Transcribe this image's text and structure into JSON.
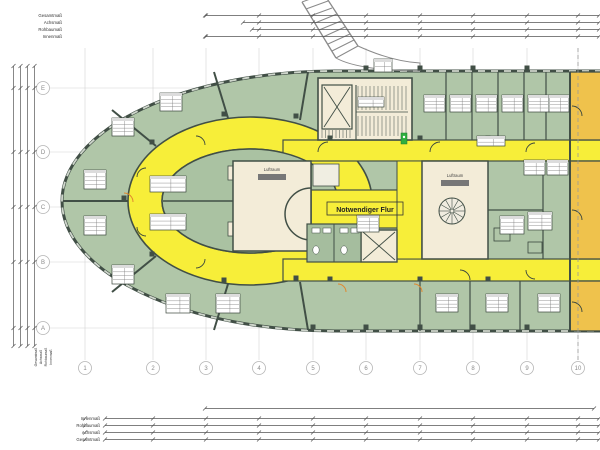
{
  "colors": {
    "room_green": "#b0c6a8",
    "island_green": "#aac2a2",
    "wc_green": "#a5bd9e",
    "corridor_yellow": "#f7ee39",
    "void_beige": "#f3ecd8",
    "orange_room": "#efc24c",
    "wall": "#414f46",
    "grid_gray": "#d4d4d4",
    "dim_line": "#555555",
    "exit_green": "#2fae3e",
    "door_orange": "#e0882f"
  },
  "dimensions": {
    "top_labels": [
      "Gesamtmaß",
      "Achsmaß",
      "Rohbaumaß",
      "Innenmaß"
    ],
    "bottom_labels": [
      "Innenmaß",
      "Rohbaumaß",
      "Achsmaß",
      "Gesamtmaß"
    ],
    "left_rotated_labels": [
      "Gesamtmaß",
      "Achsmaß",
      "Rohbaumaß",
      "Innenmaß"
    ]
  },
  "grid": {
    "row_labels": [
      "E",
      "D",
      "C",
      "B",
      "A"
    ],
    "row_y": [
      88,
      152,
      207,
      262,
      328
    ],
    "col_labels": [
      "1",
      "2",
      "3",
      "4",
      "5",
      "6",
      "7",
      "8",
      "9",
      "10"
    ],
    "col_x": [
      85,
      153,
      206,
      259,
      313,
      366,
      420,
      473,
      527,
      578
    ]
  },
  "plan_labels": {
    "corridor": "Notwendiger Flur",
    "void_left": "Luftraum",
    "void_right": "Luftraum"
  },
  "room_stamps": [
    {
      "x": 160,
      "y": 93,
      "w": 22,
      "h": 18
    },
    {
      "x": 112,
      "y": 118,
      "w": 22,
      "h": 18
    },
    {
      "x": 84,
      "y": 170,
      "w": 22,
      "h": 19
    },
    {
      "x": 84,
      "y": 216,
      "w": 22,
      "h": 19
    },
    {
      "x": 112,
      "y": 265,
      "w": 22,
      "h": 19
    },
    {
      "x": 166,
      "y": 294,
      "w": 24,
      "h": 19
    },
    {
      "x": 216,
      "y": 294,
      "w": 24,
      "h": 19
    },
    {
      "x": 150,
      "y": 176,
      "w": 36,
      "h": 16
    },
    {
      "x": 150,
      "y": 214,
      "w": 36,
      "h": 16
    },
    {
      "x": 424,
      "y": 95,
      "w": 21,
      "h": 17
    },
    {
      "x": 450,
      "y": 95,
      "w": 21,
      "h": 17
    },
    {
      "x": 476,
      "y": 95,
      "w": 21,
      "h": 17
    },
    {
      "x": 502,
      "y": 95,
      "w": 21,
      "h": 17
    },
    {
      "x": 528,
      "y": 95,
      "w": 21,
      "h": 17
    },
    {
      "x": 549,
      "y": 95,
      "w": 20,
      "h": 17
    },
    {
      "x": 436,
      "y": 294,
      "w": 22,
      "h": 18
    },
    {
      "x": 486,
      "y": 294,
      "w": 22,
      "h": 18
    },
    {
      "x": 538,
      "y": 294,
      "w": 22,
      "h": 18
    },
    {
      "x": 524,
      "y": 160,
      "w": 21,
      "h": 15
    },
    {
      "x": 547,
      "y": 160,
      "w": 21,
      "h": 15
    },
    {
      "x": 500,
      "y": 216,
      "w": 24,
      "h": 18
    },
    {
      "x": 528,
      "y": 212,
      "w": 24,
      "h": 18
    },
    {
      "x": 357,
      "y": 215,
      "w": 22,
      "h": 17
    },
    {
      "x": 477,
      "y": 136,
      "w": 28,
      "h": 10
    },
    {
      "x": 358,
      "y": 97,
      "w": 26,
      "h": 10
    },
    {
      "x": 374,
      "y": 59,
      "w": 18,
      "h": 13
    }
  ]
}
